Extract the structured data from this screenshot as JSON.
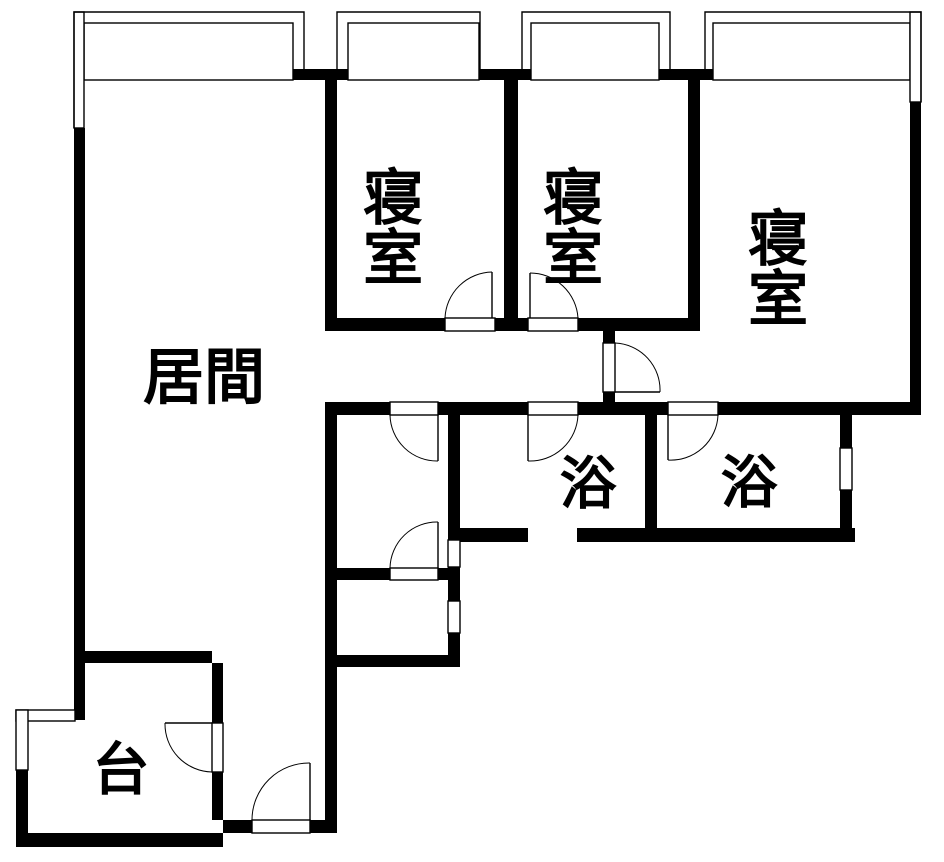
{
  "app": {
    "type": "architectural-floor-plan"
  },
  "plan": {
    "canvas": {
      "width": 944,
      "height": 862,
      "background": "#ffffff",
      "wall_color": "#000000"
    },
    "rooms": [
      {
        "id": "living-room",
        "label": "居間",
        "x": 204,
        "y": 378,
        "font_size": 61,
        "vertical": false
      },
      {
        "id": "bedroom-1",
        "label": "寝室",
        "x": 387,
        "y": 226,
        "font_size": 60,
        "vertical": true
      },
      {
        "id": "bedroom-2",
        "label": "寝室",
        "x": 567,
        "y": 226,
        "font_size": 60,
        "vertical": true
      },
      {
        "id": "bedroom-3",
        "label": "寝室",
        "x": 772,
        "y": 267,
        "font_size": 60,
        "vertical": true
      },
      {
        "id": "bath-1",
        "label": "浴",
        "x": 588,
        "y": 484,
        "font_size": 57,
        "vertical": false
      },
      {
        "id": "bath-2",
        "label": "浴",
        "x": 749,
        "y": 483,
        "font_size": 57,
        "vertical": false
      },
      {
        "id": "kitchen",
        "label": "台",
        "x": 121,
        "y": 770,
        "font_size": 57,
        "vertical": false
      }
    ],
    "geometry": {
      "walls": [
        [
          293,
          69,
          55,
          11
        ],
        [
          479,
          69,
          52,
          11
        ],
        [
          659,
          69,
          54,
          11
        ],
        [
          74,
          128,
          11,
          592
        ],
        [
          325,
          80,
          12,
          238
        ],
        [
          504,
          80,
          14,
          238
        ],
        [
          688,
          80,
          12,
          241
        ],
        [
          910,
          102,
          11,
          310
        ],
        [
          325,
          318,
          120,
          13
        ],
        [
          495,
          318,
          33,
          13
        ],
        [
          578,
          318,
          122,
          13
        ],
        [
          603,
          331,
          12,
          12
        ],
        [
          603,
          392,
          12,
          11
        ],
        [
          325,
          402,
          65,
          13
        ],
        [
          438,
          402,
          90,
          13
        ],
        [
          578,
          402,
          90,
          13
        ],
        [
          718,
          402,
          203,
          13
        ],
        [
          325,
          402,
          12,
          431
        ],
        [
          448,
          402,
          12,
          138
        ],
        [
          448,
          567,
          12,
          34
        ],
        [
          448,
          633,
          12,
          34
        ],
        [
          325,
          568,
          65,
          12
        ],
        [
          438,
          568,
          22,
          12
        ],
        [
          325,
          655,
          135,
          12
        ],
        [
          645,
          415,
          12,
          113
        ],
        [
          840,
          412,
          12,
          36
        ],
        [
          840,
          490,
          12,
          38
        ],
        [
          460,
          528,
          68,
          14
        ],
        [
          577,
          528,
          278,
          14
        ],
        [
          75,
          651,
          137,
          12
        ],
        [
          212,
          663,
          11,
          60
        ],
        [
          212,
          772,
          11,
          48
        ],
        [
          16,
          770,
          12,
          77
        ],
        [
          223,
          820,
          29,
          13
        ],
        [
          310,
          820,
          26,
          13
        ],
        [
          16,
          833,
          207,
          14
        ]
      ],
      "windows": [
        [
          84,
          23,
          209,
          57
        ],
        [
          348,
          23,
          131,
          57
        ],
        [
          531,
          23,
          128,
          57
        ],
        [
          713,
          23,
          197,
          57
        ],
        [
          74,
          12,
          10,
          116
        ],
        [
          910,
          12,
          11,
          90
        ],
        [
          840,
          448,
          12,
          42
        ],
        [
          448,
          540,
          12,
          27
        ],
        [
          448,
          601,
          12,
          32
        ],
        [
          16,
          710,
          59,
          11
        ],
        [
          16,
          710,
          12,
          60
        ]
      ],
      "balconies": [
        "M 74 128 L 74 12 L 304 12 L 304 69",
        "M 337 69 L 337 12 L 480 12 L 480 69",
        "M 522 69 L 522 12 L 670 12 L 670 69",
        "M 705 69 L 705 12 L 921 12 L 921 102"
      ],
      "doors": [
        {
          "id": "bedroom-1-door",
          "threshold": [
            445,
            318,
            50,
            13
          ],
          "leaf": [
            492,
            272,
            492,
            318
          ],
          "arc": "M 445 318 A 48 48 0 0 1 492 272"
        },
        {
          "id": "bedroom-2-door",
          "threshold": [
            528,
            318,
            50,
            13
          ],
          "leaf": [
            530,
            273,
            530,
            318
          ],
          "arc": "M 578 318 A 48 48 0 0 0 530 273"
        },
        {
          "id": "bedroom-3-door",
          "threshold": [
            603,
            343,
            12,
            49
          ],
          "leaf": [
            615,
            392,
            660,
            392
          ],
          "arc": "M 615 343 A 47 47 0 0 1 660 392"
        },
        {
          "id": "washroom-north-door",
          "threshold": [
            390,
            402,
            48,
            13
          ],
          "leaf": [
            438,
            415,
            438,
            461
          ],
          "arc": "M 390 415 A 47 47 0 0 0 438 461"
        },
        {
          "id": "washroom-south-door",
          "threshold": [
            390,
            568,
            48,
            12
          ],
          "leaf": [
            438,
            522,
            438,
            568
          ],
          "arc": "M 390 568 A 47 47 0 0 1 438 522"
        },
        {
          "id": "bath-1-door",
          "threshold": [
            528,
            402,
            50,
            13
          ],
          "leaf": [
            528,
            415,
            528,
            461
          ],
          "arc": "M 578 415 A 48 48 0 0 1 528 461"
        },
        {
          "id": "bath-2-door",
          "threshold": [
            668,
            402,
            50,
            13
          ],
          "leaf": [
            668,
            415,
            668,
            460
          ],
          "arc": "M 718 415 A 47 47 0 0 1 668 460"
        },
        {
          "id": "kitchen-door",
          "threshold": [
            212,
            723,
            11,
            49
          ],
          "leaf": [
            165,
            723,
            212,
            723
          ],
          "arc": "M 212 772 A 48 48 0 0 1 165 723"
        },
        {
          "id": "entrance-door",
          "threshold": [
            252,
            820,
            58,
            13
          ],
          "leaf": [
            310,
            763,
            310,
            820
          ],
          "arc": "M 252 820 A 57 57 0 0 1 310 763"
        }
      ]
    }
  }
}
